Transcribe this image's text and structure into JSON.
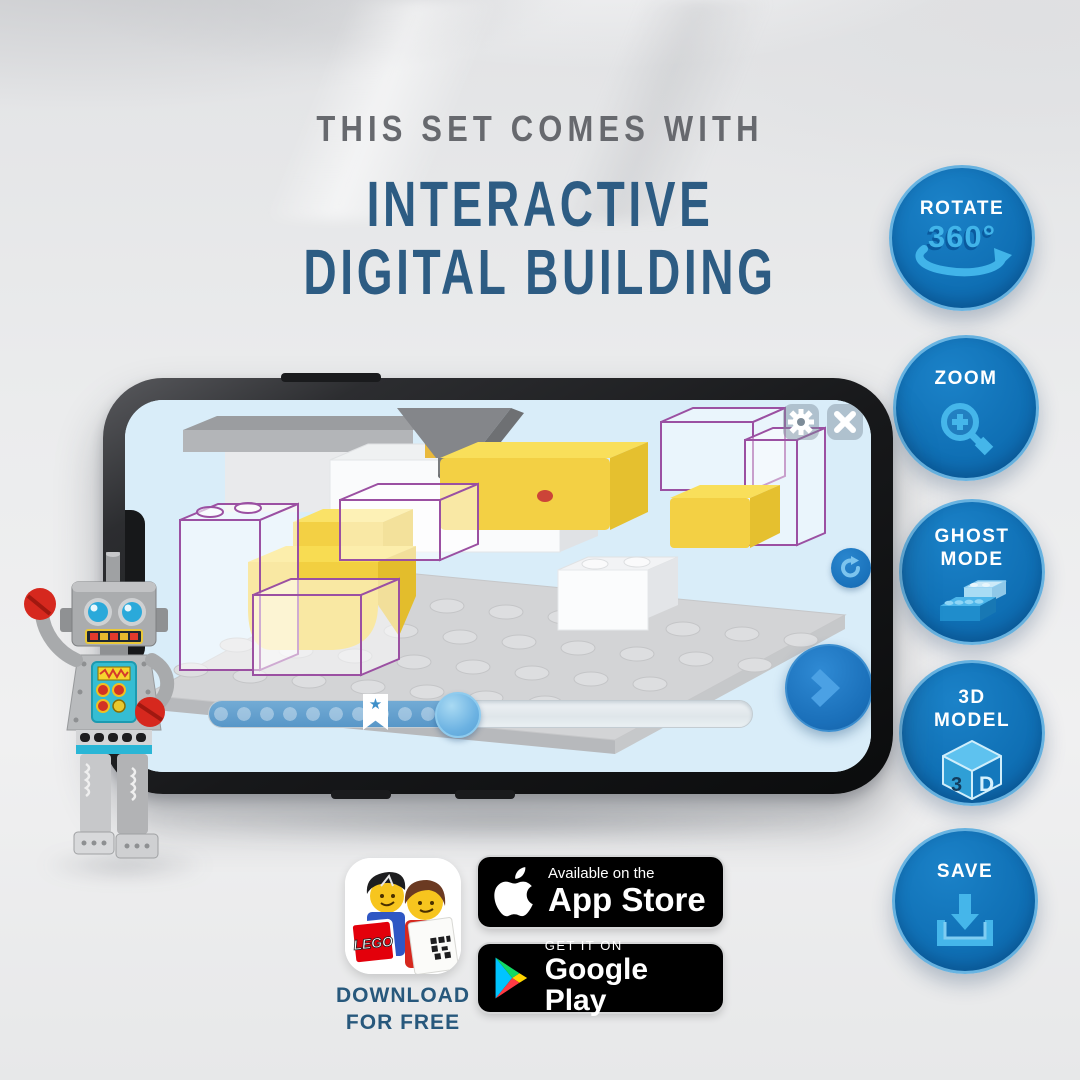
{
  "headline": {
    "eyebrow": "THIS SET COMES WITH",
    "title_line1": "INTERACTIVE",
    "title_line2": "DIGITAL BUILDING"
  },
  "features": [
    {
      "title": "ROTATE",
      "accent": "360°",
      "icon": "rotate-360-arrow-icon"
    },
    {
      "title": "ZOOM",
      "icon": "magnifier-plus-icon"
    },
    {
      "title": "GHOST",
      "title2": "MODE",
      "icon": "ghost-bricks-icon"
    },
    {
      "title": "3D",
      "title2": "MODEL",
      "icon": "cube-3d-icon",
      "icon_text_left": "3",
      "icon_text_right": "D"
    },
    {
      "title": "SAVE",
      "icon": "download-tray-icon"
    }
  ],
  "phone_app": {
    "screen_buttons": [
      "settings-gear",
      "close",
      "reset-rotation",
      "next-step"
    ],
    "slider": {
      "fill_percent": 46,
      "bookmark_percent": 31,
      "star_glyph": "★"
    }
  },
  "promo": {
    "download_line1": "DOWNLOAD",
    "download_line2": "FOR FREE",
    "app_icon_logo_text": "LEGO"
  },
  "store_badges": {
    "app_store": {
      "tagline": "Available on the",
      "name": "App Store"
    },
    "google_play": {
      "tagline": "GET IT ON",
      "name": "Google Play"
    }
  },
  "colors": {
    "eyebrow_gray": "#67696e",
    "headline_blue": "#2d5c83",
    "badge_blue": "#0f6fb4",
    "badge_icon_blue": "#41b4e9",
    "screen_bg": "#d9edf9",
    "ghost_outline_purple": "#9b50a2",
    "brick_yellow": "#f3d044"
  }
}
